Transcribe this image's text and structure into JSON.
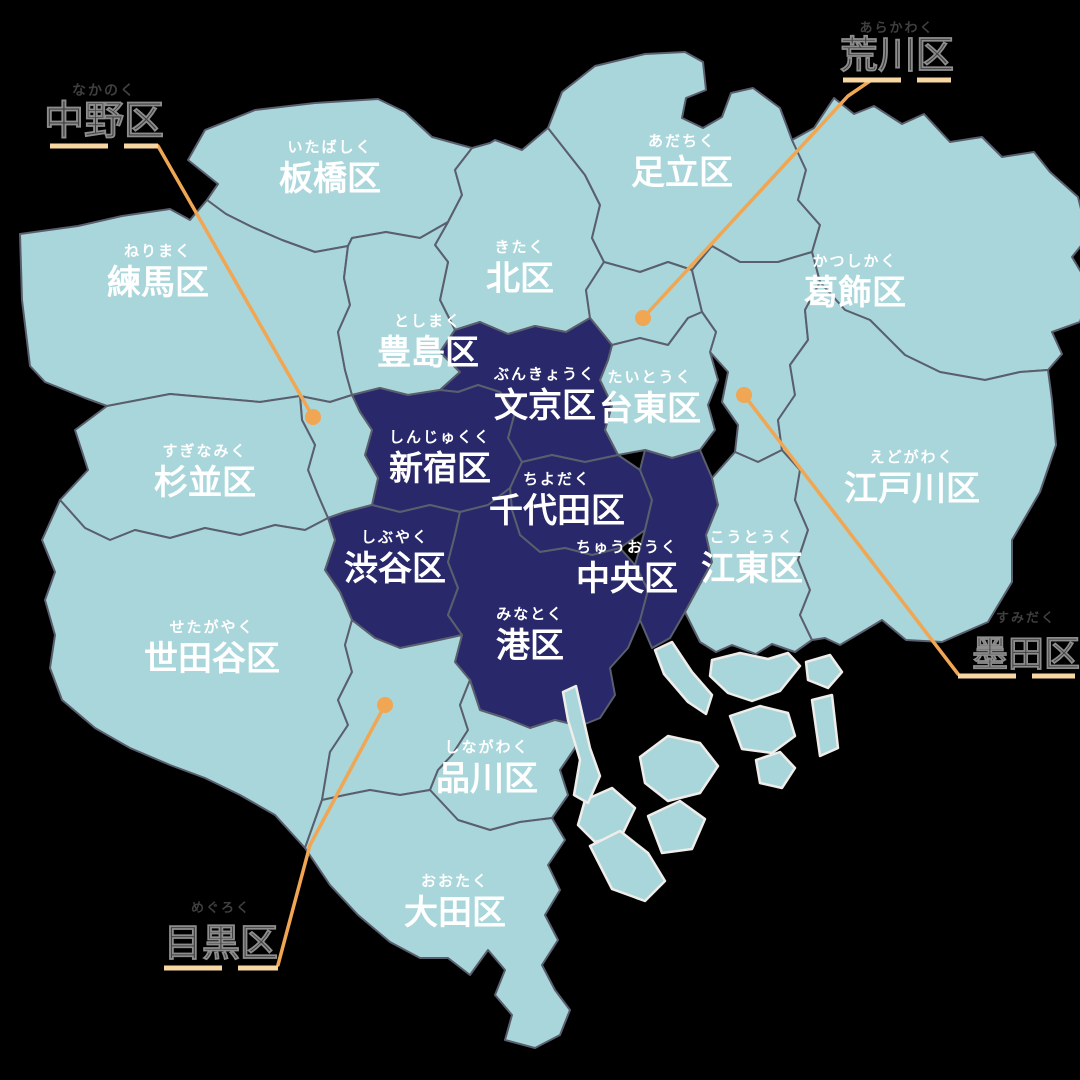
{
  "canvas": {
    "width": 1080,
    "height": 1080,
    "background": "#000000"
  },
  "palette": {
    "ward_fill": "#a9d6da",
    "highlight_fill": "#28286a",
    "border": "#5a5f6e",
    "island_stroke": "#efedea",
    "label_color": "#ffffff",
    "callout_text": "#3f3f3f",
    "callout_halo": "#8d8d8d",
    "leader_line": "#f0a652",
    "underline": "#f8d7a2"
  },
  "map_title": "tokyo-23-wards-map",
  "wards": [
    {
      "id": "itabashi",
      "name": "板橋区",
      "furigana": "いたばしく",
      "highlighted": false,
      "label": {
        "x": 330,
        "y": 178
      },
      "points": "188,160 205,130 255,110 315,103 378,99 405,112 432,137 472,148 455,170 462,195 448,222 420,238 386,232 352,238 348,246 315,252 282,240 252,227 226,214 207,200 218,184"
    },
    {
      "id": "nerima",
      "name": "練馬区",
      "furigana": "ねりまく",
      "highlighted": false,
      "label": {
        "x": 158,
        "y": 282
      },
      "points": "207,200 226,214 252,227 282,240 315,252 348,246 344,278 350,305 338,332 345,370 352,395 330,402 300,396 260,402 215,398 170,394 128,402 107,406 85,398 45,382 30,366 22,300 20,234 78,226 122,216 170,209 190,220"
    },
    {
      "id": "kita",
      "name": "北区",
      "furigana": "きたく",
      "highlighted": false,
      "label": {
        "x": 520,
        "y": 278
      },
      "points": "472,148 490,143 495,140 522,150 548,128 585,175 600,205 592,238 604,262 586,290 590,318 566,332 535,326 508,334 480,322 455,330 440,300 448,262 435,245 448,222 462,195 455,170"
    },
    {
      "id": "adachi",
      "name": "足立区",
      "furigana": "あだちく",
      "highlighted": false,
      "label": {
        "x": 682,
        "y": 172
      },
      "points": "548,128 562,92 595,66 645,54 685,52 703,62 706,90 686,98 682,118 703,128 722,117 731,93 753,88 780,108 792,140 806,170 798,200 820,225 812,252 778,262 740,262 712,246 692,270 668,262 640,272 604,262 592,238 600,205 585,175"
    },
    {
      "id": "katsushika",
      "name": "葛飾区",
      "furigana": "かつしかく",
      "highlighted": false,
      "label": {
        "x": 855,
        "y": 292
      },
      "points": "792,140 814,128 834,98 854,114 874,106 902,124 924,114 950,142 982,137 1002,157 1034,152 1050,172 1078,197 1088,237 1072,257 1090,287 1080,322 1052,332 1062,354 1048,370 1020,372 985,380 940,372 905,355 870,320 845,310 820,282 812,252 820,225 798,200 806,170"
    },
    {
      "id": "arakawa",
      "name": "荒川区",
      "furigana": "あらかわく",
      "highlighted": false,
      "label": null,
      "points": "604,262 640,272 668,262 692,270 702,312 688,318 668,345 640,338 612,345 590,318 586,290"
    },
    {
      "id": "toshima",
      "name": "豊島区",
      "furigana": "としまく",
      "highlighted": false,
      "label": {
        "x": 428,
        "y": 352
      },
      "points": "348,246 352,238 386,232 420,238 448,222 435,245 448,262 440,300 455,330 440,352 460,372 440,390 408,395 380,388 352,395 345,370 338,332 350,305 344,278"
    },
    {
      "id": "sumida",
      "name": "墨田区",
      "furigana": "すみだく",
      "highlighted": false,
      "label": null,
      "points": "692,270 712,246 740,262 778,262 812,252 820,282 805,310 808,340 790,365 795,395 778,420 782,450 758,462 735,452 738,425 722,402 728,372 710,352 716,332 702,312"
    },
    {
      "id": "taito",
      "name": "台東区",
      "furigana": "たいとうく",
      "highlighted": false,
      "label": {
        "x": 650,
        "y": 408
      },
      "points": "612,345 640,338 668,345 688,318 702,312 716,332 710,352 718,380 708,405 715,430 700,450 672,458 645,450 618,455 605,430 612,405 600,380 608,360"
    },
    {
      "id": "bunkyo",
      "name": "文京区",
      "furigana": "ぶんきょうく",
      "highlighted": true,
      "label": {
        "x": 545,
        "y": 405
      },
      "points": "440,390 460,372 440,352 455,330 480,322 508,334 535,326 566,332 590,318 612,345 608,360 600,380 612,405 605,430 618,455 585,462 552,455 522,462 508,438 515,412 500,392 478,385 458,392"
    },
    {
      "id": "shinjuku",
      "name": "新宿区",
      "furigana": "しんじゅくく",
      "highlighted": true,
      "label": {
        "x": 440,
        "y": 468
      },
      "points": "352,395 380,388 408,395 440,390 458,392 478,385 500,392 515,412 508,438 522,462 510,488 488,505 460,512 430,505 400,512 372,505 378,478 365,455 372,430 360,412"
    },
    {
      "id": "nakano",
      "name": "中野区",
      "furigana": "なかのく",
      "highlighted": false,
      "label": null,
      "points": "300,396 330,402 352,395 360,412 372,430 365,455 378,478 372,505 345,512 328,518 318,495 308,470 315,445 302,420"
    },
    {
      "id": "suginami",
      "name": "杉並区",
      "furigana": "すぎなみく",
      "highlighted": false,
      "label": {
        "x": 205,
        "y": 482
      },
      "points": "107,406 128,402 170,394 215,398 260,402 300,396 302,420 315,445 308,470 318,495 328,518 305,530 275,525 240,535 205,528 170,538 135,530 110,540 85,528 60,500 88,470 75,430"
    },
    {
      "id": "chiyoda",
      "name": "千代田区",
      "furigana": "ちよだく",
      "highlighted": true,
      "label": {
        "x": 557,
        "y": 510
      },
      "points": "522,462 552,455 585,462 618,455 640,470 652,500 645,530 620,548 592,555 565,548 540,552 520,535 512,510 510,488"
    },
    {
      "id": "chuo",
      "name": "中央区",
      "furigana": "ちゅうおうく",
      "highlighted": true,
      "label": {
        "x": 627,
        "y": 578
      },
      "points": "645,450 672,458 700,450 712,478 718,505 706,535 712,562 698,588 685,612 670,638 652,648 640,620 648,590 635,565 645,530 652,500 640,470"
    },
    {
      "id": "shibuya",
      "name": "渋谷区",
      "furigana": "しぶやく",
      "highlighted": true,
      "label": {
        "x": 395,
        "y": 568
      },
      "points": "372,505 400,512 430,505 460,512 455,535 448,562 458,588 448,615 462,635 430,642 400,648 375,638 352,620 340,592 325,570 335,540 328,518 345,512"
    },
    {
      "id": "minato",
      "name": "港区",
      "furigana": "みなとく",
      "highlighted": true,
      "label": {
        "x": 530,
        "y": 645
      },
      "points": "510,488 512,510 520,535 540,552 565,548 592,555 620,548 635,565 648,590 640,620 628,648 610,668 615,695 600,718 580,726 555,720 530,728 505,718 480,710 470,680 455,662 462,635 448,615 458,588 448,562 455,535 460,512 488,505"
    },
    {
      "id": "koto",
      "name": "江東区",
      "furigana": "こうとうく",
      "highlighted": false,
      "label": {
        "x": 752,
        "y": 568
      },
      "points": "735,452 758,462 782,450 800,470 795,500 808,530 798,560 810,590 800,615 812,640 795,652 772,644 756,654 732,645 716,652 700,642 685,612 698,588 712,562 706,535 718,505 712,478"
    },
    {
      "id": "edogawa",
      "name": "江戸川区",
      "furigana": "えどがわく",
      "highlighted": false,
      "label": {
        "x": 912,
        "y": 488
      },
      "points": "820,282 845,310 870,320 905,355 940,372 985,380 1020,372 1048,370 1052,400 1056,445 1040,492 1012,540 1012,582 988,622 942,642 906,640 882,620 862,632 840,645 825,638 812,640 800,615 810,590 798,560 808,530 795,500 800,470 782,450 778,420 795,395 790,365 808,340 805,310"
    },
    {
      "id": "setagaya",
      "name": "世田谷区",
      "furigana": "せたがやく",
      "highlighted": false,
      "label": {
        "x": 212,
        "y": 658
      },
      "points": "60,500 85,528 110,540 135,530 170,538 205,528 240,535 275,525 305,530 328,518 335,540 325,570 340,592 352,620 345,645 352,672 338,700 348,725 330,752 322,800 305,848 275,815 240,795 205,778 170,765 130,748 95,728 62,700 50,668 55,635 45,600 55,572 42,540"
    },
    {
      "id": "meguro",
      "name": "目黒区",
      "furigana": "めぐろく",
      "highlighted": false,
      "label": null,
      "points": "352,620 375,638 400,648 430,642 462,635 455,662 470,680 460,705 468,730 452,755 438,770 430,790 400,795 370,790 345,795 322,800 330,752 348,725 338,700 352,672 345,645"
    },
    {
      "id": "shinagawa",
      "name": "品川区",
      "furigana": "しながわく",
      "highlighted": false,
      "label": {
        "x": 487,
        "y": 778
      },
      "points": "505,718 530,728 555,720 580,726 575,748 560,770 568,795 552,818 520,822 490,830 458,820 430,790 438,770 452,755 468,730 460,705 470,680 480,710"
    },
    {
      "id": "ota",
      "name": "大田区",
      "furigana": "おおたく",
      "highlighted": false,
      "label": {
        "x": 455,
        "y": 912
      },
      "points": "430,790 458,820 490,830 520,822 552,818 565,840 548,865 560,890 545,915 558,940 542,965 555,990 570,1010 560,1035 535,1048 505,1040 512,1015 495,995 505,970 488,950 470,975 448,958 420,958 390,942 358,915 330,885 305,848 322,800 345,795 370,790 400,795"
    }
  ],
  "islands": [
    {
      "points": "655,650 672,642 692,672 712,695 706,714 688,702 664,674"
    },
    {
      "points": "712,660 740,653 768,659 788,653 800,666 780,691 752,701 728,693 710,676"
    },
    {
      "points": "640,757 668,736 700,743 718,766 700,793 668,801 645,783"
    },
    {
      "points": "730,716 760,706 788,713 795,736 772,753 742,749"
    },
    {
      "points": "806,662 830,655 842,672 828,688 808,680"
    },
    {
      "points": "585,800 612,788 635,808 622,835 595,842 578,825"
    },
    {
      "points": "648,816 680,801 705,819 692,849 662,853"
    },
    {
      "points": "563,692 576,686 590,748 600,776 588,803 574,795 580,760 568,720"
    },
    {
      "points": "590,846 620,831 648,853 665,881 645,901 612,889"
    },
    {
      "points": "812,700 832,695 838,748 820,756"
    },
    {
      "points": "756,760 780,752 795,768 782,788 760,783"
    }
  ],
  "callouts": [
    {
      "id": "nakano",
      "name": "中野区",
      "furigana": "なかのく",
      "kanji": {
        "x": 104,
        "y": 134,
        "size": 40
      },
      "furi": {
        "x": 104,
        "y": 95,
        "size": 14
      },
      "underline": {
        "x1": 50,
        "y1": 146,
        "x2": 158,
        "y2": 146
      },
      "leader": "158,146 313,417",
      "dot": {
        "x": 313,
        "y": 417,
        "r": 8
      }
    },
    {
      "id": "arakawa",
      "name": "荒川区",
      "furigana": "あらかわく",
      "kanji": {
        "x": 897,
        "y": 68,
        "size": 38
      },
      "furi": {
        "x": 897,
        "y": 32,
        "size": 13
      },
      "underline": {
        "x1": 843,
        "y1": 80,
        "x2": 951,
        "y2": 80
      },
      "leader": "870,81 848,96 643,318",
      "dot": {
        "x": 643,
        "y": 318,
        "r": 8
      }
    },
    {
      "id": "sumida",
      "name": "墨田区",
      "furigana": "すみだく",
      "kanji": {
        "x": 1026,
        "y": 666,
        "size": 36
      },
      "furi": {
        "x": 1026,
        "y": 622,
        "size": 13
      },
      "underline": {
        "x1": 958,
        "y1": 676,
        "x2": 1075,
        "y2": 676
      },
      "leader": "958,674 744,395",
      "dot": {
        "x": 744,
        "y": 395,
        "r": 8
      }
    },
    {
      "id": "meguro",
      "name": "目黒区",
      "furigana": "めぐろく",
      "kanji": {
        "x": 221,
        "y": 956,
        "size": 38
      },
      "furi": {
        "x": 221,
        "y": 912,
        "size": 13
      },
      "underline": {
        "x1": 164,
        "y1": 968,
        "x2": 278,
        "y2": 968
      },
      "leader": "278,965 310,845 385,705",
      "dot": {
        "x": 385,
        "y": 705,
        "r": 8
      }
    }
  ],
  "label_style": {
    "kanji_size": 34,
    "furigana_size": 15
  }
}
